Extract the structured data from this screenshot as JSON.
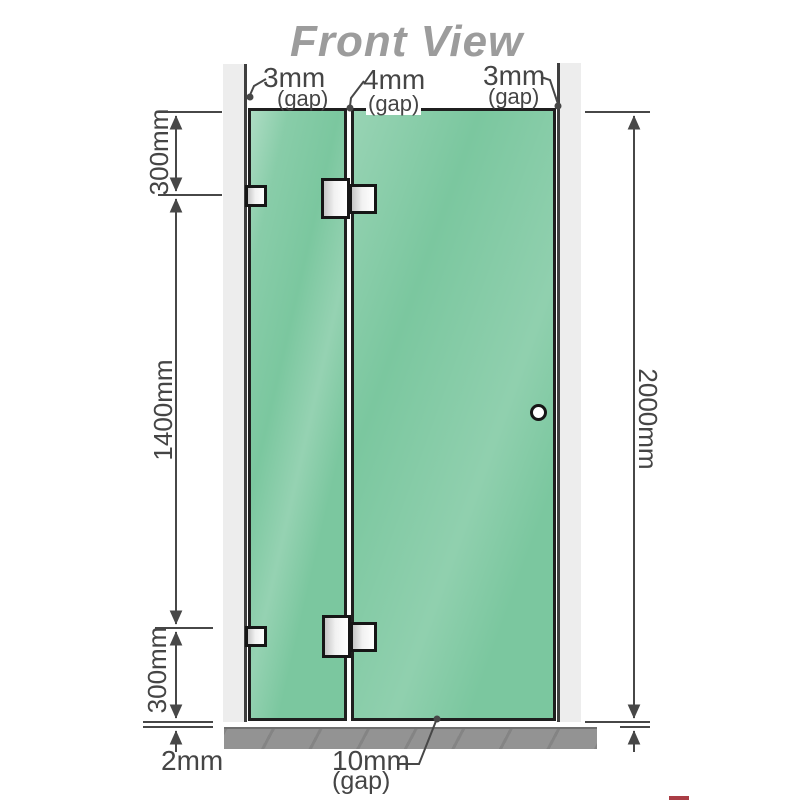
{
  "title": "Front View",
  "dimensions": {
    "top_gap_left": {
      "value": "3mm",
      "note": "(gap)"
    },
    "top_gap_middle": {
      "value": "4mm",
      "note": "(gap)"
    },
    "top_gap_right": {
      "value": "3mm",
      "note": "(gap)"
    },
    "left_top": "300mm",
    "left_middle": "1400mm",
    "left_bottom": "300mm",
    "floor_gap_left": "2mm",
    "right_height": "2000mm",
    "bottom_gap": {
      "value": "10mm",
      "note": "(gap)"
    }
  },
  "colors": {
    "glass_green": "#7bc79f",
    "wall_gray": "#ededed",
    "floor_gray": "#939393",
    "line_dark": "#474747",
    "title_gray": "#9c9c9c"
  }
}
